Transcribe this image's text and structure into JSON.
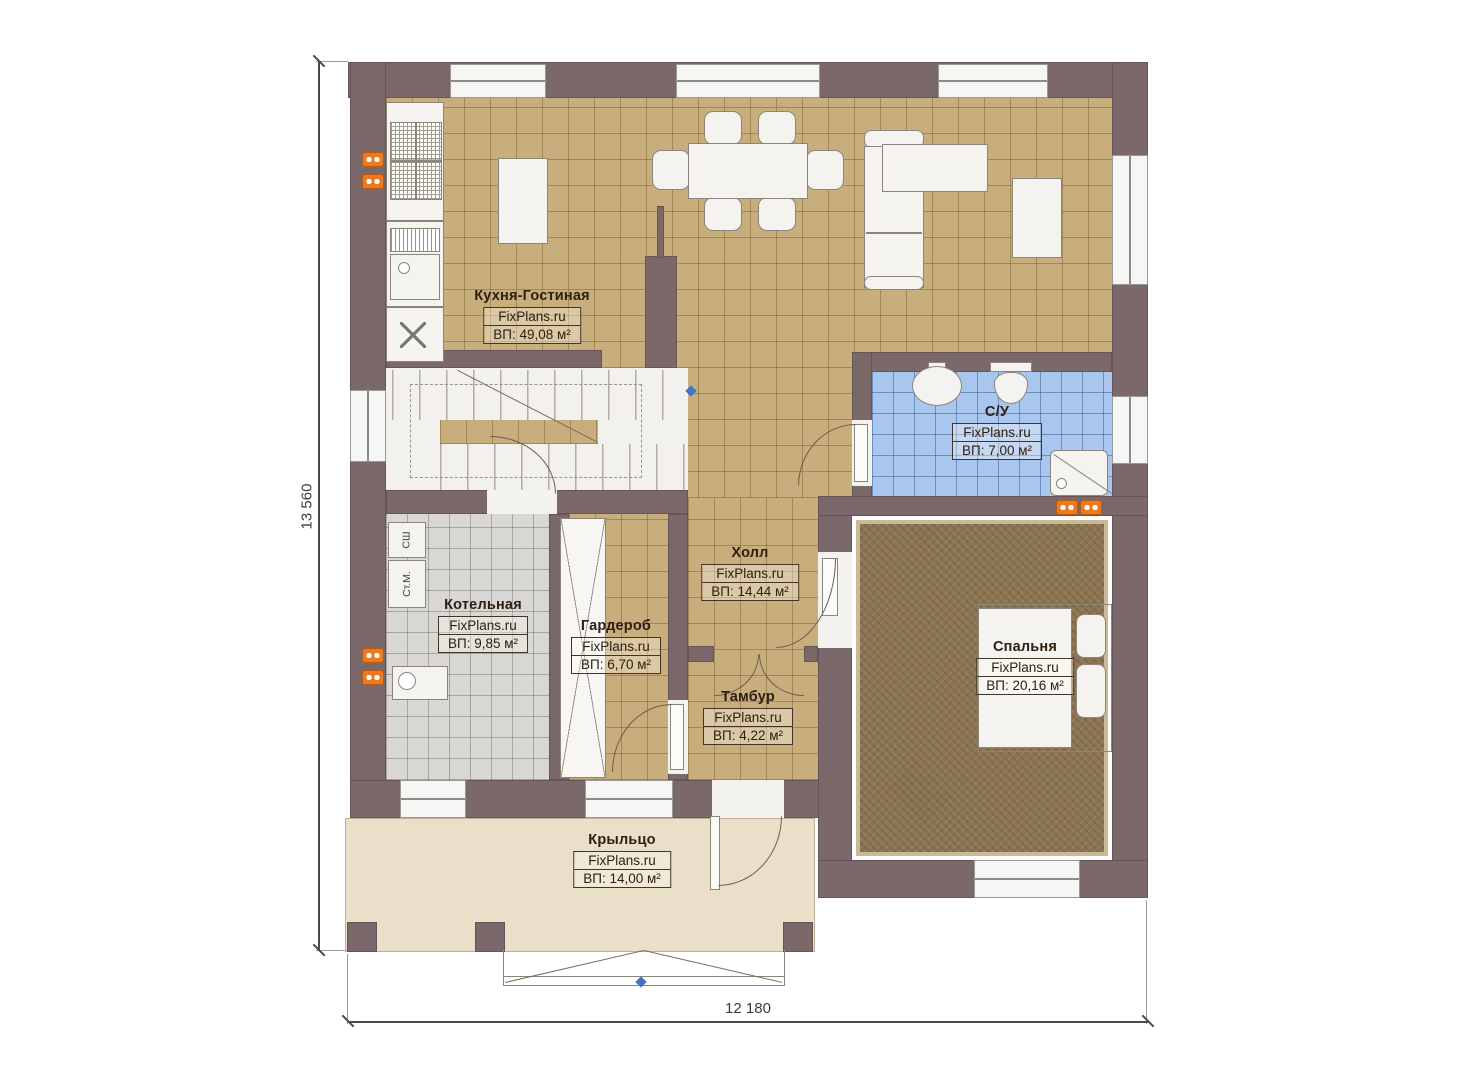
{
  "brand": "FixPlans.ru",
  "rooms": [
    {
      "name": "Кухня-Гостиная",
      "area": "ВП: 49,08 м²"
    },
    {
      "name": "С/У",
      "area": "ВП: 7,00 м²"
    },
    {
      "name": "Холл",
      "area": "ВП: 14,44 м²"
    },
    {
      "name": "Котельная",
      "area": "ВП: 9,85 м²"
    },
    {
      "name": "Гардероб",
      "area": "ВП: 6,70 м²"
    },
    {
      "name": "Тамбур",
      "area": "ВП: 4,22 м²"
    },
    {
      "name": "Спальня",
      "area": "ВП: 20,16 м²"
    },
    {
      "name": "Крыльцо",
      "area": "ВП: 14,00 м²"
    }
  ],
  "dimensions": {
    "vertical": "13 560",
    "horizontal": "12 180"
  },
  "appliances": {
    "dryer": "СШ",
    "washer": "Ст.М."
  },
  "colors": {
    "wall": "#7b686b",
    "kitchen_floor": "#c8ae7d",
    "bath_floor": "#a9c7ee",
    "boiler_floor": "#d8d7d4",
    "carpet": "#8b7450",
    "porch_floor": "#eadfc9",
    "socket": "#ee7a1f",
    "marker": "#4472c4"
  }
}
